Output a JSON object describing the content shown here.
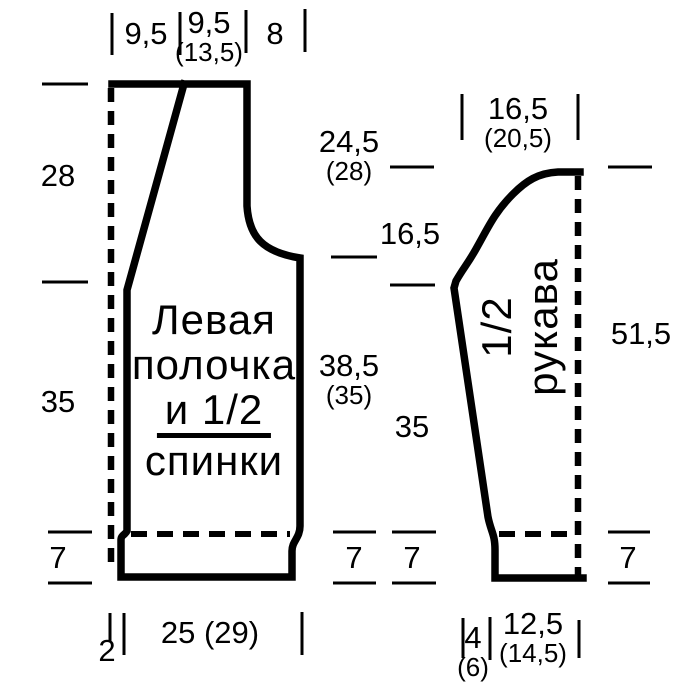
{
  "colors": {
    "line": "#000000",
    "background": "#ffffff"
  },
  "body": {
    "label": {
      "line1": "Левая",
      "line2": "полочка",
      "line3": "и 1/2",
      "line4": "спинки"
    },
    "top": {
      "left": "9,5",
      "mid_main": "9,5",
      "mid_alt": "(13,5)",
      "right": "8"
    },
    "left_col": {
      "upper": "28",
      "middle": "35",
      "rib": "7"
    },
    "right_col": {
      "armhole_main": "24,5",
      "armhole_alt": "(28)",
      "side_main": "38,5",
      "side_alt": "(35)",
      "rib": "7"
    },
    "bottom": {
      "offset": "2",
      "width": "25 (29)"
    }
  },
  "sleeve": {
    "label": {
      "line1": "1/2",
      "line2": "рукава"
    },
    "top": {
      "width_main": "16,5",
      "width_alt": "(20,5)"
    },
    "left_col": {
      "cap": "16,5",
      "lower": "35",
      "rib": "7"
    },
    "right_col": {
      "total": "51,5",
      "rib": "7"
    },
    "bottom": {
      "offset_main": "4",
      "offset_alt": "(6)",
      "cuff_main": "12,5",
      "cuff_alt": "(14,5)"
    }
  }
}
